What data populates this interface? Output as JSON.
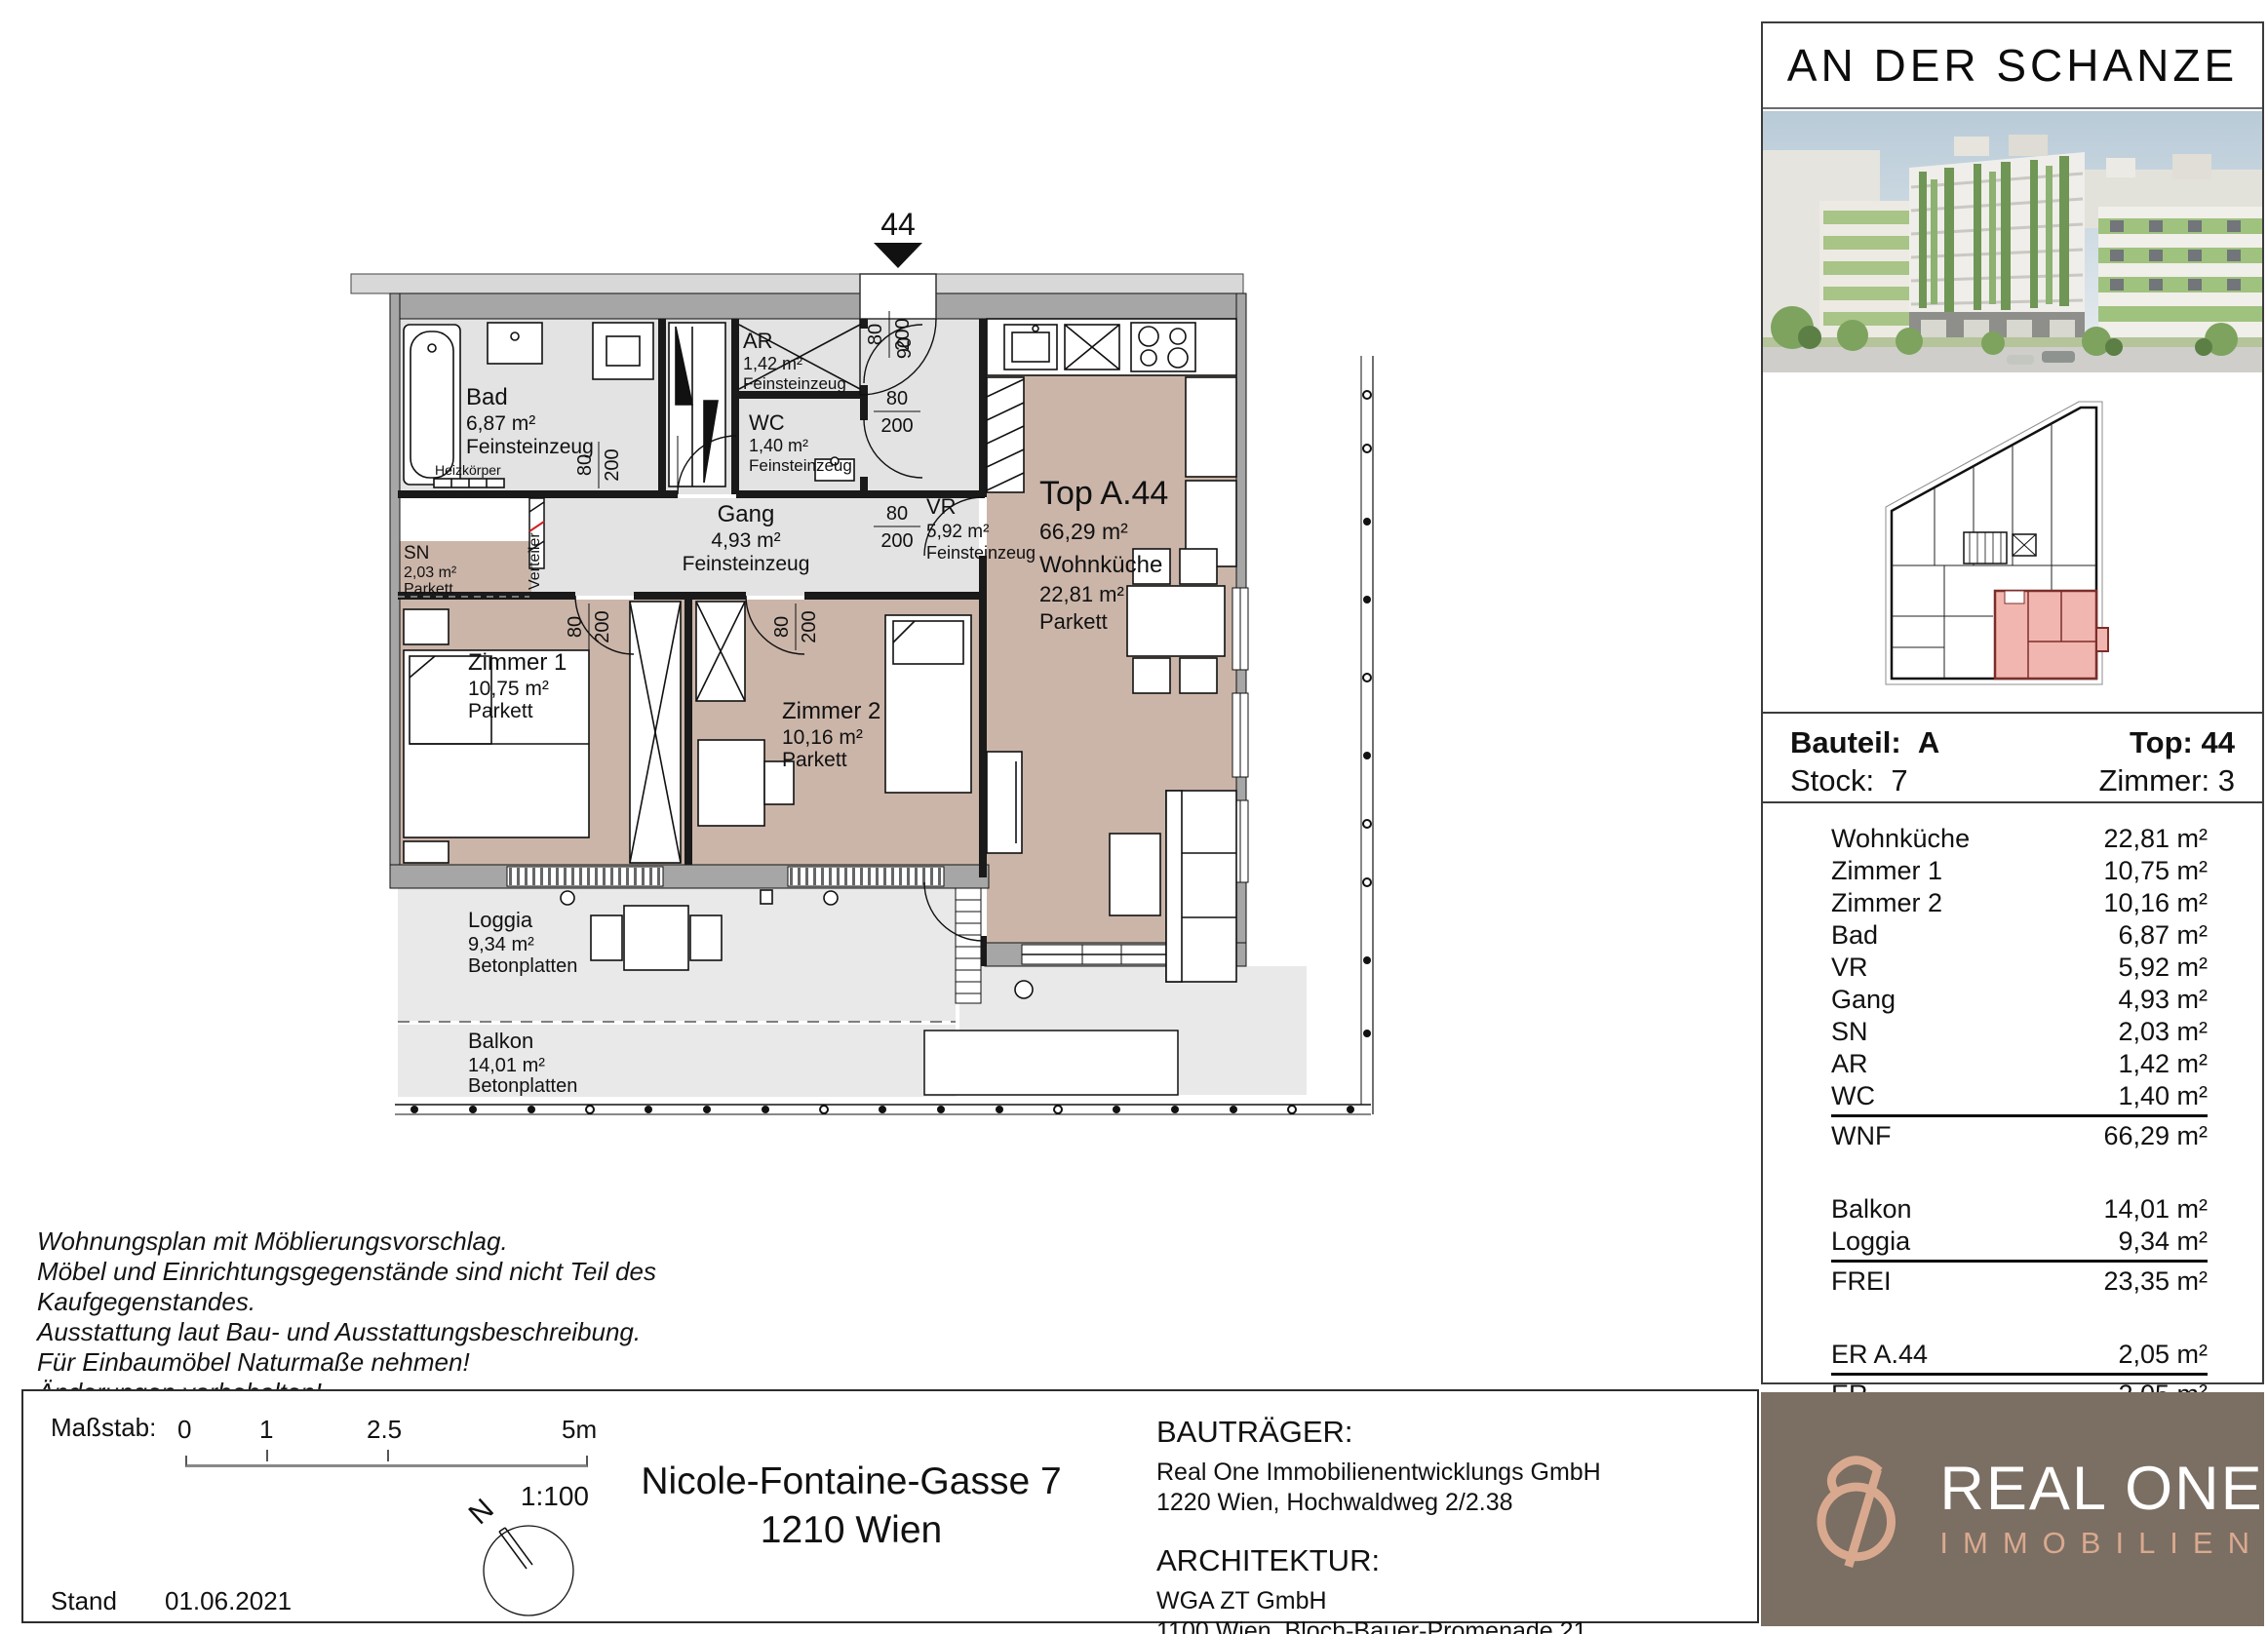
{
  "sidebar": {
    "project_title": "AN DER SCHANZE",
    "info": {
      "bauteil_label": "Bauteil:",
      "bauteil_value": "A",
      "top_label": "Top:",
      "top_value": "44",
      "stock_label": "Stock:",
      "stock_value": "7",
      "zimmer_label": "Zimmer:",
      "zimmer_value": "3"
    },
    "areas": {
      "rows": [
        {
          "name": "Wohnküche",
          "value": "22,81 m²"
        },
        {
          "name": "Zimmer 1",
          "value": "10,75 m²"
        },
        {
          "name": "Zimmer 2",
          "value": "10,16 m²"
        },
        {
          "name": "Bad",
          "value": "6,87 m²"
        },
        {
          "name": "VR",
          "value": "5,92 m²"
        },
        {
          "name": "Gang",
          "value": "4,93 m²"
        },
        {
          "name": "SN",
          "value": "2,03 m²"
        },
        {
          "name": "AR",
          "value": "1,42 m²"
        },
        {
          "name": "WC",
          "value": "1,40 m²"
        },
        {
          "name": "WNF",
          "value": "66,29 m²"
        },
        {
          "name": "Balkon",
          "value": "14,01 m²"
        },
        {
          "name": "Loggia",
          "value": "9,34 m²"
        },
        {
          "name": "FREI",
          "value": "23,35 m²"
        },
        {
          "name": "ER A.44",
          "value": "2,05 m²"
        },
        {
          "name": "ER",
          "value": "2,05 m²"
        }
      ]
    }
  },
  "plan": {
    "entrance_number": "44",
    "doors": {
      "w80": "80",
      "w90": "90",
      "h200": "200"
    },
    "verteiler_label": "Verteiler",
    "heizkoerper_label": "Heizkörper",
    "rooms": {
      "bad": {
        "name": "Bad",
        "area": "6,87 m²",
        "floor": "Feinsteinzeug"
      },
      "ar": {
        "name": "AR",
        "area": "1,42 m²",
        "floor": "Feinsteinzeug"
      },
      "wc": {
        "name": "WC",
        "area": "1,40 m²",
        "floor": "Feinsteinzeug"
      },
      "vr": {
        "name": "VR",
        "area": "5,92 m²",
        "floor": "Feinsteinzeug"
      },
      "gang": {
        "name": "Gang",
        "area": "4,93 m²",
        "floor": "Feinsteinzeug"
      },
      "sn": {
        "name": "SN",
        "area": "2,03 m²",
        "floor": "Parkett"
      },
      "zimmer1": {
        "name": "Zimmer 1",
        "area": "10,75 m²",
        "floor": "Parkett"
      },
      "zimmer2": {
        "name": "Zimmer 2",
        "area": "10,16 m²",
        "floor": "Parkett"
      },
      "top": {
        "name": "Top A.44",
        "area": "66,29 m²",
        "subname": "Wohnküche",
        "subarea": "22,81 m²",
        "floor": "Parkett"
      },
      "loggia": {
        "name": "Loggia",
        "area": "9,34 m²",
        "floor": "Betonplatten"
      },
      "balkon": {
        "name": "Balkon",
        "area": "14,01 m²",
        "floor": "Betonplatten"
      }
    }
  },
  "disclaimer": {
    "line1": "Wohnungsplan mit Möblierungsvorschlag.",
    "line2": "Möbel und Einrichtungsgegenstände sind nicht Teil des",
    "line3": "Kaufgegenstandes.",
    "line4": "Ausstattung laut Bau- und Ausstattungsbeschreibung.",
    "line5": "Für Einbaumöbel Naturmaße nehmen!",
    "line6": "Änderungen vorbehalten!"
  },
  "scale": {
    "label": "Maßstab:",
    "tick0": "0",
    "tick1": "1",
    "tick2": "2.5",
    "tick3": "5m",
    "ratio": "1:100",
    "stand_label": "Stand",
    "stand_date": "01.06.2021",
    "north": "N"
  },
  "address": {
    "line1": "Nicole-Fontaine-Gasse 7",
    "line2": "1210 Wien"
  },
  "contacts": {
    "developer_heading": "BAUTRÄGER:",
    "developer_name": "Real One Immobilienentwicklungs GmbH",
    "developer_address": "1220 Wien, Hochwaldweg 2/2.38",
    "architect_heading": "ARCHITEKTUR:",
    "architect_name": "WGA ZT GmbH",
    "architect_address": "1100 Wien, Bloch-Bauer-Promenade 21"
  },
  "brand": {
    "name": "REAL ONE",
    "subtitle": "IMMOBILIEN"
  },
  "colors": {
    "accent_red": "#e8402f",
    "parkett_floor": "#cbb5a9",
    "tile_floor": "#e3e3e3",
    "brand_brown": "#7b6e63",
    "brand_rose": "#d9a98f",
    "unit_highlight": "#f2b6b0"
  }
}
